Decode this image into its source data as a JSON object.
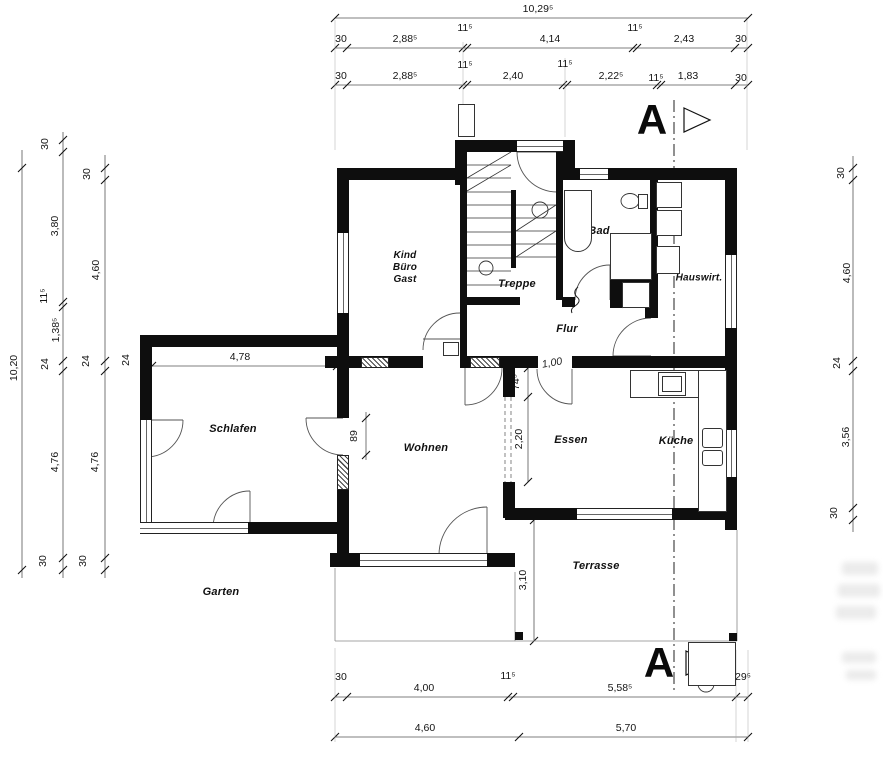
{
  "drawing": {
    "rooms": {
      "kind": [
        "Kind",
        "Büro",
        "Gast"
      ],
      "treppe": "Treppe",
      "bad": "Bad",
      "hauswirt": "Hauswirt.",
      "flur": "Flur",
      "schlafen": "Schlafen",
      "wohnen": "Wohnen",
      "essen": "Essen",
      "kueche": "Küche",
      "terrasse": "Terrasse",
      "garten": "Garten"
    },
    "fixtures": {
      "washing_machine": "WM",
      "dryer": "TR",
      "shower": "Du.",
      "shower_size": "150/90"
    },
    "section_marker": "A",
    "dims": {
      "top_total": "10,29⁵",
      "top_row1": [
        "30",
        "2,88⁵",
        "11⁵",
        "4,14",
        "11⁵",
        "2,43",
        "30"
      ],
      "top_row2": [
        "30",
        "2,88⁵",
        "11⁵",
        "2,40",
        "11⁵",
        "2,22⁵",
        "11⁵",
        "1,83",
        "30"
      ],
      "left_total": "10,20",
      "left_mid": [
        "30",
        "3,80",
        "11⁵",
        "1,38⁵",
        "24",
        "4,76",
        "30"
      ],
      "left_inner": [
        "30",
        "4,60",
        "24",
        "4,76",
        "30"
      ],
      "wall_thickness": "24",
      "right": [
        "30",
        "4,60",
        "24",
        "3,56",
        "30"
      ],
      "bottom_row1": [
        "30",
        "4,00",
        "11⁵",
        "5,58⁵",
        "29⁵"
      ],
      "bottom_row2": [
        "4,60",
        "5,70"
      ],
      "schlafen_width": "4,78",
      "door_width": "89",
      "pier": "74⁵",
      "opening": "2,20",
      "terrace_depth": "3,10",
      "handwritten": "1,00"
    }
  }
}
